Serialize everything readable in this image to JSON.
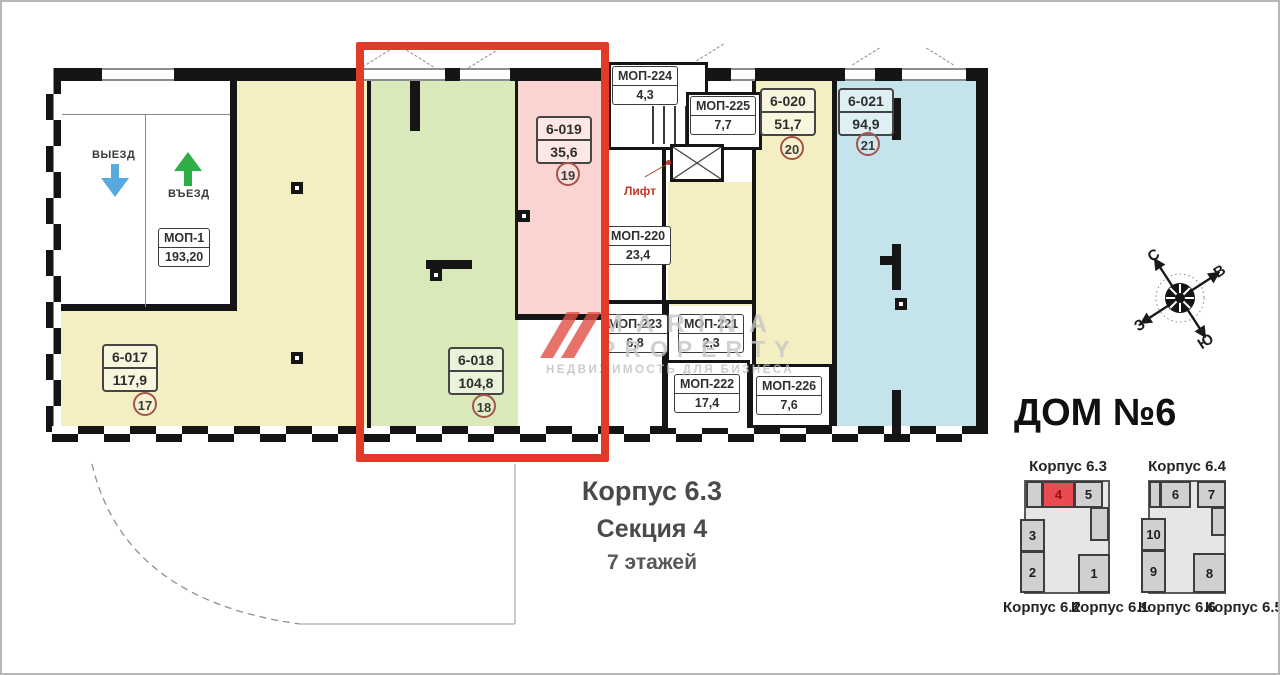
{
  "plan": {
    "garage": {
      "exit": "ВЫЕЗД",
      "enter": "ВЪЕЗД",
      "mop": {
        "name": "МОП-1",
        "area": "193,20"
      }
    },
    "units": [
      {
        "id": "6-017",
        "area": "117,9",
        "num": "17"
      },
      {
        "id": "6-018",
        "area": "104,8",
        "num": "18"
      },
      {
        "id": "6-019",
        "area": "35,6",
        "num": "19"
      },
      {
        "id": "6-020",
        "area": "51,7",
        "num": "20"
      },
      {
        "id": "6-021",
        "area": "94,9",
        "num": "21"
      }
    ],
    "mops": [
      {
        "name": "МОП-224",
        "area": "4,3"
      },
      {
        "name": "МОП-225",
        "area": "7,7"
      },
      {
        "name": "МОП-220",
        "area": "23,4"
      },
      {
        "name": "МОП-223",
        "area": "6,8"
      },
      {
        "name": "МОП-221",
        "area": "2,3"
      },
      {
        "name": "МОП-222",
        "area": "17,4"
      },
      {
        "name": "МОП-226",
        "area": "7,6"
      }
    ],
    "elevator": "Лифт"
  },
  "caption": {
    "building": "Корпус 6.3",
    "section": "Секция 4",
    "floors": "7 этажей"
  },
  "compass": {
    "north": "С",
    "east": "В",
    "south": "Ю",
    "west": "З"
  },
  "watermark": {
    "brand_top": "MARINA",
    "brand_bottom": "PROPERTY",
    "tagline": "НЕДВИЖИМОСТЬ ДЛЯ БИЗНЕСА"
  },
  "house": {
    "title": "ДОМ №6",
    "top_labels": [
      "Корпус 6.3",
      "Корпус 6.4"
    ],
    "bottom_labels": [
      "Корпус 6.2",
      "Корпус 6.1",
      "Корпус 6.6",
      "Корпус 6.5"
    ],
    "left_sections": [
      {
        "num": "4",
        "highlighted": true
      },
      {
        "num": "5"
      },
      {
        "num": "3"
      },
      {
        "num": "2"
      },
      {
        "num": "1"
      }
    ],
    "right_sections": [
      {
        "num": "6"
      },
      {
        "num": "7"
      },
      {
        "num": "10"
      },
      {
        "num": "9"
      },
      {
        "num": "8"
      }
    ]
  },
  "colors": {
    "unit_yellow": "#f4efc3",
    "unit_green": "#d9e9ba",
    "unit_pink": "#f9d4d0",
    "unit_blue": "#c4e3eb",
    "highlight_red": "#e23b28",
    "minimap_red": "#ea4a52",
    "exit_arrow_blue": "#57a9de",
    "enter_arrow_green": "#2fae46"
  }
}
